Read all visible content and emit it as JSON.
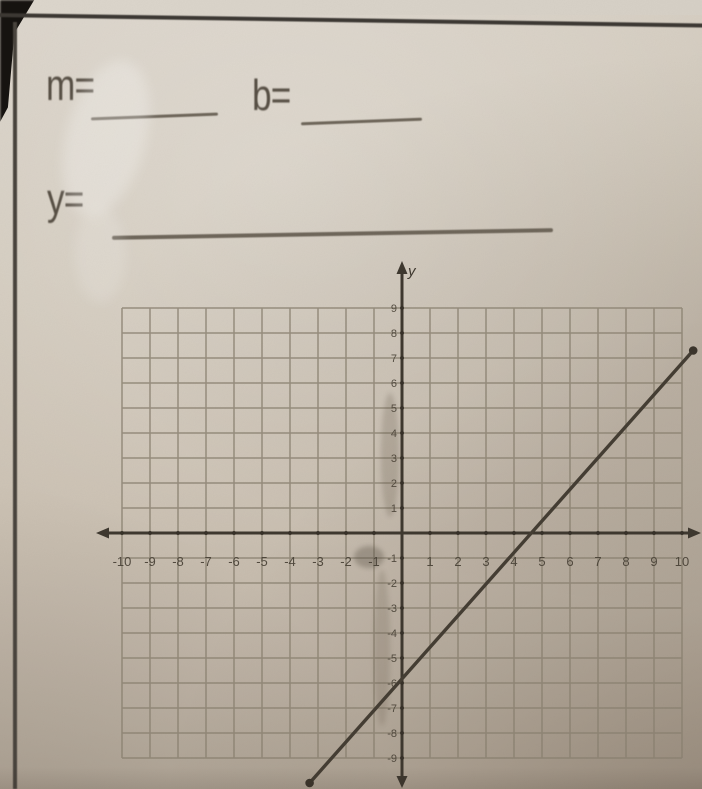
{
  "worksheet": {
    "m_label": "m=",
    "b_label": "b=",
    "y_label": "y="
  },
  "graph": {
    "axis_y_title": "y",
    "x_labels_negative": [
      "-10",
      "-9",
      "-8",
      "-7",
      "-6",
      "-5",
      "-4",
      "-3",
      "-2",
      "-1"
    ],
    "x_labels_positive": [
      "1",
      "2",
      "3",
      "4",
      "5",
      "6",
      "7",
      "8",
      "9",
      "10"
    ],
    "y_labels_positive": [
      "9",
      "8",
      "7",
      "6",
      "5",
      "4",
      "3",
      "2",
      "1"
    ],
    "y_labels_negative": [
      "-1",
      "-2",
      "-3",
      "-4",
      "-5",
      "-6",
      "-7",
      "-8",
      "-9"
    ]
  },
  "chart_data": {
    "type": "line",
    "title": "",
    "xlabel": "",
    "ylabel": "y",
    "x_range": [
      -10,
      10
    ],
    "y_range": [
      -9,
      9
    ],
    "grid": true,
    "legend": false,
    "series": [
      {
        "name": "student-graphed-line",
        "style": "straight pencil segment with round dots at both ends",
        "points": [
          [
            -3.3,
            -10
          ],
          [
            10.4,
            7.3
          ]
        ],
        "x_intercept_est": 4.8,
        "y_intercept_est": -6,
        "slope_est": 1.25,
        "equation_est": "y = 1.25x - 6 (approx)"
      }
    ]
  },
  "colors": {
    "paper": "#cfc5b8",
    "border_ink": "#3c3833",
    "axis_ink": "#3e382f",
    "grid_line": "#8a8171",
    "pencil_line": "#443d33",
    "printed_text": "#574f44"
  }
}
